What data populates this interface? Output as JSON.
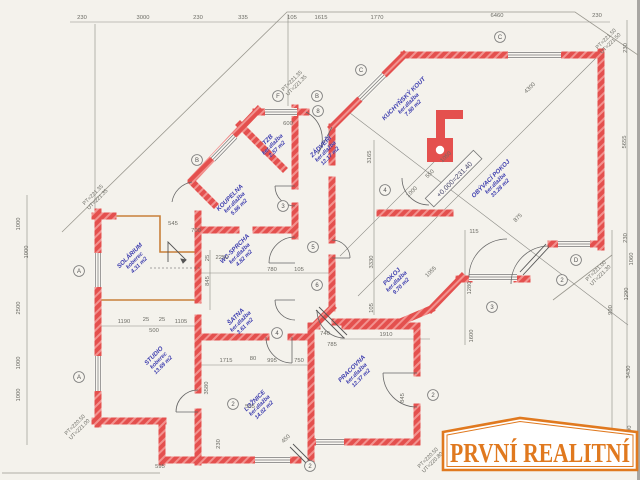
{
  "logo": {
    "text": "PRVNÍ REALITNÍ",
    "color": "#e0791f"
  },
  "level_note": {
    "text": "+0.000=231.40",
    "x": 455,
    "y": 180
  },
  "colors": {
    "wall": "#e4504e",
    "solarium_wall": "#c8803a",
    "room_label": "#3c3cae",
    "dim_text": "#6b6b64",
    "line": "#8a8a84"
  },
  "rooms": [
    {
      "name": "SOLÁRIUM",
      "floor": "koberec",
      "area": "4.31 m2",
      "x": 131,
      "y": 257
    },
    {
      "name": "STUDIO",
      "floor": "koberec",
      "area": "13.69 m2",
      "x": 155,
      "y": 357
    },
    {
      "name": "KOUPELNA",
      "floor": "ker.dlažba",
      "area": "5.86 m2",
      "x": 231,
      "y": 199
    },
    {
      "name": "TZB",
      "floor": "ker.dlažba",
      "area": "2.57 m2",
      "x": 269,
      "y": 141
    },
    {
      "name": "ZÁDVEŘÍ",
      "floor": "ker.dlažba",
      "area": "12.17 m2",
      "x": 322,
      "y": 148
    },
    {
      "name": "KUCHYŇSKÝ KOUT",
      "floor": "ker.dlažba",
      "area": "7.80 m2",
      "x": 405,
      "y": 100
    },
    {
      "name": "OBÝVACÍ POKOJ",
      "floor": "ker.dlažba",
      "area": "33.28 m2",
      "x": 492,
      "y": 180
    },
    {
      "name": "WC-SPRCHA",
      "floor": "ker.dlažba",
      "area": "4.82 m2",
      "x": 236,
      "y": 250
    },
    {
      "name": "ŠATNA",
      "floor": "ker.dlažba",
      "area": "3.61 m2",
      "x": 237,
      "y": 318
    },
    {
      "name": "POKOJ",
      "floor": "ker.dlažba",
      "area": "9.70 m2",
      "x": 393,
      "y": 278
    },
    {
      "name": "LOŽNICE",
      "floor": "ker.dlažba",
      "area": "14.02 m2",
      "x": 256,
      "y": 402
    },
    {
      "name": "PRACOVNA",
      "floor": "ker.dlažba",
      "area": "12.37 m2",
      "x": 353,
      "y": 370
    }
  ],
  "dimensions": [
    {
      "t": "230",
      "x": 82,
      "y": 19,
      "o": "h"
    },
    {
      "t": "3000",
      "x": 143,
      "y": 19,
      "o": "h"
    },
    {
      "t": "230",
      "x": 198,
      "y": 19,
      "o": "h"
    },
    {
      "t": "335",
      "x": 243,
      "y": 19,
      "o": "h"
    },
    {
      "t": "105",
      "x": 292,
      "y": 19,
      "o": "h"
    },
    {
      "t": "1615",
      "x": 321,
      "y": 19,
      "o": "h"
    },
    {
      "t": "1770",
      "x": 377,
      "y": 19,
      "o": "h"
    },
    {
      "t": "6460",
      "x": 497,
      "y": 17,
      "o": "h"
    },
    {
      "t": "230",
      "x": 597,
      "y": 17,
      "o": "h"
    },
    {
      "t": "1000",
      "x": 20,
      "y": 224,
      "o": "v"
    },
    {
      "t": "1000",
      "x": 28,
      "y": 252,
      "o": "v"
    },
    {
      "t": "2500",
      "x": 20,
      "y": 308,
      "o": "v"
    },
    {
      "t": "1000",
      "x": 20,
      "y": 363,
      "o": "v"
    },
    {
      "t": "1000",
      "x": 20,
      "y": 395,
      "o": "v"
    },
    {
      "t": "230",
      "x": 627,
      "y": 48,
      "o": "v"
    },
    {
      "t": "5655",
      "x": 626,
      "y": 142,
      "o": "v"
    },
    {
      "t": "230",
      "x": 627,
      "y": 238,
      "o": "v"
    },
    {
      "t": "1060",
      "x": 633,
      "y": 259,
      "o": "v"
    },
    {
      "t": "1290",
      "x": 628,
      "y": 294,
      "o": "v"
    },
    {
      "t": "3430",
      "x": 630,
      "y": 372,
      "o": "v"
    },
    {
      "t": "1200",
      "x": 631,
      "y": 432,
      "o": "v"
    },
    {
      "t": "990",
      "x": 612,
      "y": 310,
      "o": "v"
    },
    {
      "t": "600",
      "x": 288,
      "y": 125,
      "o": "h"
    },
    {
      "t": "545",
      "x": 173,
      "y": 225,
      "o": "h"
    },
    {
      "t": "700",
      "x": 196,
      "y": 232,
      "o": "h"
    },
    {
      "t": "2250",
      "x": 222,
      "y": 259,
      "o": "h"
    },
    {
      "t": "780",
      "x": 272,
      "y": 271,
      "o": "h"
    },
    {
      "t": "105",
      "x": 299,
      "y": 271,
      "o": "h"
    },
    {
      "t": "1190",
      "x": 124,
      "y": 323,
      "o": "h"
    },
    {
      "t": "25",
      "x": 146,
      "y": 321,
      "o": "h"
    },
    {
      "t": "25",
      "x": 162,
      "y": 321,
      "o": "h"
    },
    {
      "t": "1105",
      "x": 181,
      "y": 323,
      "o": "h"
    },
    {
      "t": "500",
      "x": 154,
      "y": 332,
      "o": "h"
    },
    {
      "t": "740",
      "x": 325,
      "y": 335,
      "o": "h"
    },
    {
      "t": "785",
      "x": 332,
      "y": 346,
      "o": "h"
    },
    {
      "t": "1910",
      "x": 386,
      "y": 336,
      "o": "h"
    },
    {
      "t": "1715",
      "x": 226,
      "y": 362,
      "o": "h"
    },
    {
      "t": "80",
      "x": 253,
      "y": 360,
      "o": "h"
    },
    {
      "t": "995",
      "x": 272,
      "y": 362,
      "o": "h"
    },
    {
      "t": "750",
      "x": 299,
      "y": 362,
      "o": "h"
    },
    {
      "t": "555",
      "x": 250,
      "y": 408,
      "o": "h"
    },
    {
      "t": "595",
      "x": 160,
      "y": 468,
      "o": "h"
    },
    {
      "t": "115",
      "x": 474,
      "y": 233,
      "o": "h"
    },
    {
      "t": "845",
      "x": 209,
      "y": 281,
      "o": "v"
    },
    {
      "t": "25",
      "x": 209,
      "y": 258,
      "o": "v"
    },
    {
      "t": "3165",
      "x": 371,
      "y": 157,
      "o": "v"
    },
    {
      "t": "3330",
      "x": 373,
      "y": 262,
      "o": "v"
    },
    {
      "t": "105",
      "x": 373,
      "y": 308,
      "o": "v"
    },
    {
      "t": "3580",
      "x": 208,
      "y": 388,
      "o": "v"
    },
    {
      "t": "230",
      "x": 220,
      "y": 444,
      "o": "v"
    },
    {
      "t": "1280",
      "x": 471,
      "y": 288,
      "o": "v"
    },
    {
      "t": "1600",
      "x": 473,
      "y": 336,
      "o": "v"
    },
    {
      "t": "845",
      "x": 404,
      "y": 398,
      "o": "v"
    },
    {
      "t": "875",
      "x": 519,
      "y": 219,
      "o": "d"
    },
    {
      "t": "4300",
      "x": 531,
      "y": 89,
      "o": "d"
    },
    {
      "t": "1055",
      "x": 432,
      "y": 273,
      "o": "d"
    },
    {
      "t": "1050",
      "x": 447,
      "y": 158,
      "o": "d"
    },
    {
      "t": "550",
      "x": 431,
      "y": 175,
      "o": "d"
    },
    {
      "t": "1000",
      "x": 413,
      "y": 193,
      "o": "d"
    },
    {
      "t": "450",
      "x": 287,
      "y": 440,
      "o": "d"
    }
  ],
  "markers": [
    {
      "t": "A",
      "x": 79,
      "y": 271
    },
    {
      "t": "A",
      "x": 79,
      "y": 377
    },
    {
      "t": "B",
      "x": 197,
      "y": 160
    },
    {
      "t": "F",
      "x": 278,
      "y": 96
    },
    {
      "t": "B",
      "x": 317,
      "y": 96
    },
    {
      "t": "C",
      "x": 361,
      "y": 70
    },
    {
      "t": "C",
      "x": 500,
      "y": 37
    },
    {
      "t": "D",
      "x": 576,
      "y": 260
    },
    {
      "t": "8",
      "x": 318,
      "y": 111
    },
    {
      "t": "4",
      "x": 385,
      "y": 190
    },
    {
      "t": "3",
      "x": 283,
      "y": 206
    },
    {
      "t": "5",
      "x": 313,
      "y": 247
    },
    {
      "t": "6",
      "x": 317,
      "y": 285
    },
    {
      "t": "4",
      "x": 277,
      "y": 333
    },
    {
      "t": "2",
      "x": 233,
      "y": 404
    },
    {
      "t": "2",
      "x": 310,
      "y": 466
    },
    {
      "t": "2",
      "x": 433,
      "y": 395
    },
    {
      "t": "2",
      "x": 562,
      "y": 280
    },
    {
      "t": "3",
      "x": 492,
      "y": 307
    }
  ],
  "elevations": [
    {
      "l1": "PT=221.35",
      "l2": "UT=221.35",
      "x": 293,
      "y": 82
    },
    {
      "l1": "PT=221.35",
      "l2": "UT=221.35",
      "x": 94,
      "y": 196
    },
    {
      "l1": "PT=221.50",
      "l2": "UT=221.50",
      "x": 607,
      "y": 40
    },
    {
      "l1": "PT=220.50",
      "l2": "UT=221.00",
      "x": 76,
      "y": 426
    },
    {
      "l1": "PT=221.00",
      "l2": "UT=221.30",
      "x": 597,
      "y": 272
    },
    {
      "l1": "PT=220.50",
      "l2": "UT=220.80",
      "x": 429,
      "y": 459
    }
  ]
}
